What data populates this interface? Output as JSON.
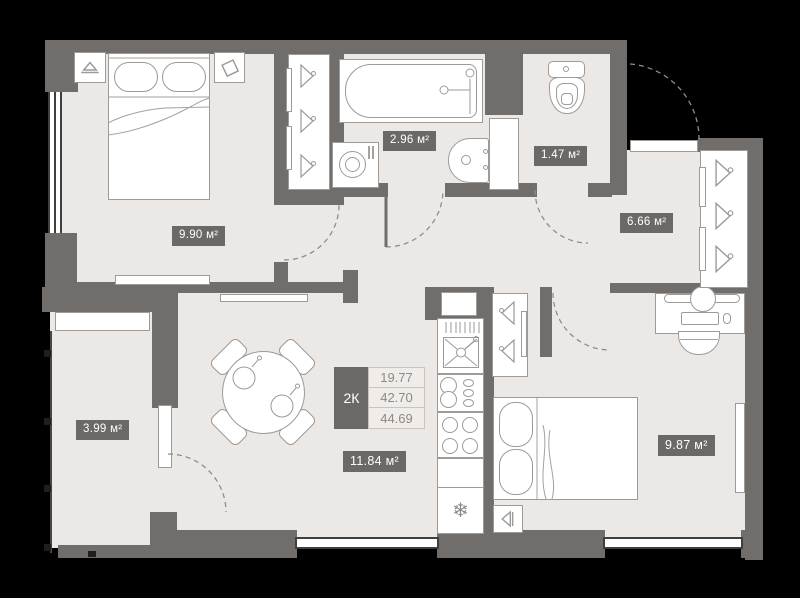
{
  "plan": {
    "title": "2K apartment floor plan",
    "summary": {
      "type": "2К",
      "values": [
        "19.77",
        "42.70",
        "44.69"
      ]
    },
    "rooms": [
      {
        "id": "bedroom-1",
        "area_label": "9.90 м²"
      },
      {
        "id": "bathroom",
        "area_label": "2.96 м²"
      },
      {
        "id": "wc",
        "area_label": "1.47 м²"
      },
      {
        "id": "hallway",
        "area_label": "6.66 м²"
      },
      {
        "id": "balcony",
        "area_label": "3.99 м²"
      },
      {
        "id": "kitchen-living",
        "area_label": "11.84 м²"
      },
      {
        "id": "bedroom-2",
        "area_label": "9.87 м²"
      }
    ],
    "icons": {
      "fridge_snowflake": "❄"
    },
    "colors": {
      "background": "#000000",
      "wall": "#706d6b",
      "floor": "#ece8e5",
      "badge": "#6b6868",
      "furniture_outline": "#9d9a97",
      "window_line": "#413f3d",
      "table_value_text": "#8d8984"
    }
  }
}
